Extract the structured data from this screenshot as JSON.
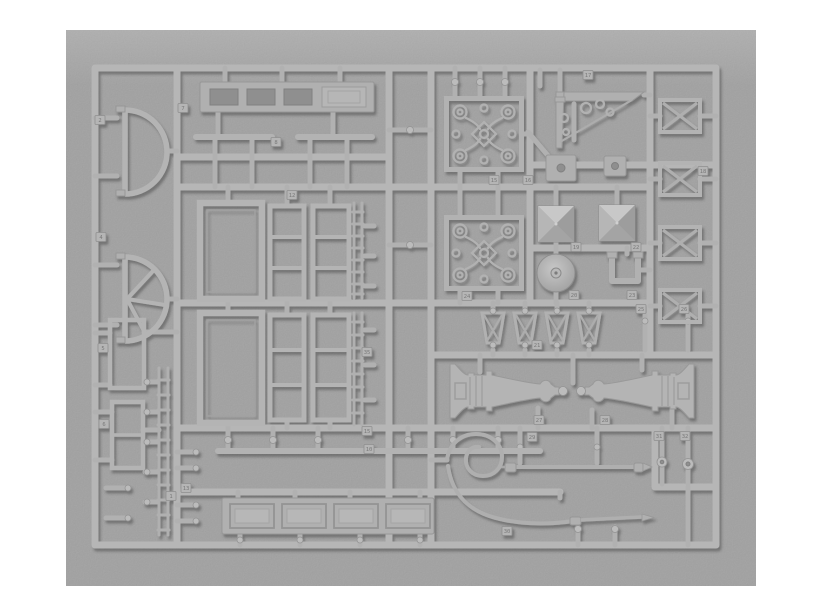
{
  "meta": {
    "subject": "Photograph of a grey styrene model kit sprue holding architectural detail parts: fanlight windows, door and window frames, ornate scrollwork grilles, a decorative corner bracket, pyramid post caps, a round disc, cross braced frames, trapezoid balusters, two turned baluster columns, a swan neck rod, a straight rod and a panelled plank"
  },
  "palette": {
    "page_background": "#ffffff",
    "photo_background": "#9a9a9a",
    "plastic": "#b4b4b4",
    "plastic_highlight": "#c9c9c9",
    "shadow": "#3c3c3c",
    "recess": "#8f8f8f"
  },
  "sprue": {
    "material": "grey styrene",
    "part_tags": [
      {
        "tag": "2",
        "name": "fanlight-frame-plain",
        "x": 100,
        "y": 120
      },
      {
        "tag": "4",
        "name": "fanlight-frame-spoked",
        "x": 101,
        "y": 237
      },
      {
        "tag": "7",
        "name": "vent-lintel-strip",
        "x": 183,
        "y": 108
      },
      {
        "tag": "8",
        "name": "sill-bars",
        "x": 276,
        "y": 142
      },
      {
        "tag": "12",
        "name": "door-frame-large",
        "x": 292,
        "y": 195
      },
      {
        "tag": "35",
        "name": "ladder-strip",
        "x": 367,
        "y": 352
      },
      {
        "tag": "5",
        "name": "window-frame-small",
        "x": 103,
        "y": 348
      },
      {
        "tag": "6",
        "name": "window-frame-two-pane",
        "x": 104,
        "y": 424
      },
      {
        "tag": "1",
        "name": "peg-ladder",
        "x": 171,
        "y": 496
      },
      {
        "tag": "13",
        "name": "bullet-pegs",
        "x": 186,
        "y": 488
      },
      {
        "tag": "15",
        "name": "stud-rail-top",
        "x": 367,
        "y": 431
      },
      {
        "tag": "10",
        "name": "stud-rail-bottom",
        "x": 369,
        "y": 449
      },
      {
        "tag": "15",
        "name": "grille-panel-upper",
        "x": 494,
        "y": 180
      },
      {
        "tag": "16",
        "name": "grille-panel-upper",
        "x": 528,
        "y": 180
      },
      {
        "tag": "17",
        "name": "corner-bracket",
        "x": 588,
        "y": 75
      },
      {
        "tag": "18",
        "name": "cross-braced-frame",
        "x": 703,
        "y": 171
      },
      {
        "tag": "19",
        "name": "pyramid-cap-left",
        "x": 576,
        "y": 247
      },
      {
        "tag": "22",
        "name": "pyramid-cap-right",
        "x": 636,
        "y": 247
      },
      {
        "tag": "20",
        "name": "round-disc",
        "x": 574,
        "y": 295
      },
      {
        "tag": "23",
        "name": "u-bracket",
        "x": 632,
        "y": 295
      },
      {
        "tag": "24",
        "name": "grille-panel-lower",
        "x": 467,
        "y": 296
      },
      {
        "tag": "21",
        "name": "trapezoid-balusters",
        "x": 537,
        "y": 345
      },
      {
        "tag": "25",
        "name": "small-peg-left",
        "x": 641,
        "y": 309
      },
      {
        "tag": "26",
        "name": "small-peg-right",
        "x": 684,
        "y": 309
      },
      {
        "tag": "27",
        "name": "turned-baluster-left",
        "x": 539,
        "y": 420
      },
      {
        "tag": "28",
        "name": "turned-baluster-right",
        "x": 605,
        "y": 420
      },
      {
        "tag": "29",
        "name": "straight-rod",
        "x": 532,
        "y": 437
      },
      {
        "tag": "30",
        "name": "swan-neck-rod",
        "x": 507,
        "y": 531
      },
      {
        "tag": "31",
        "name": "ball-pin-left",
        "x": 659,
        "y": 436
      },
      {
        "tag": "32",
        "name": "ball-pin-right",
        "x": 685,
        "y": 436
      }
    ]
  }
}
